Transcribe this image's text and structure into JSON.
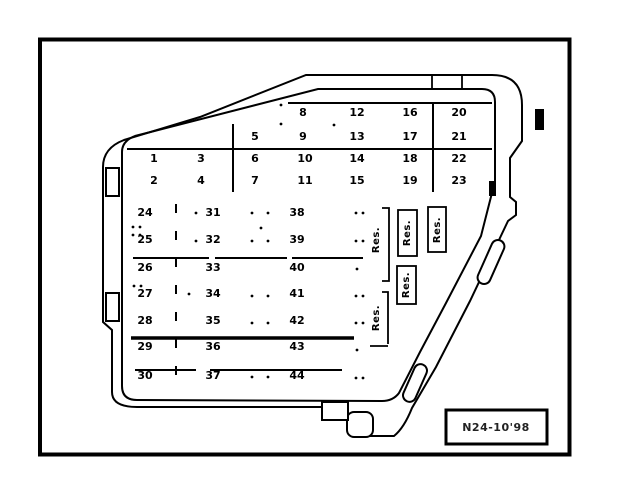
{
  "top_grid": {
    "row1": [
      "8",
      "12",
      "16",
      "20"
    ],
    "row2": [
      "5",
      "9",
      "13",
      "17",
      "21"
    ],
    "row3": [
      "1",
      "3",
      "6",
      "10",
      "14",
      "18",
      "22"
    ],
    "row4": [
      "2",
      "4",
      "7",
      "11",
      "15",
      "19",
      "23"
    ]
  },
  "bottom_grid": {
    "col1": [
      "24",
      "25",
      "26",
      "27",
      "28",
      "29",
      "30"
    ],
    "col2": [
      "31",
      "32",
      "33",
      "34",
      "35",
      "36",
      "37"
    ],
    "col3": [
      "38",
      "39",
      "40",
      "41",
      "42",
      "43",
      "44"
    ]
  },
  "reserved_labels": {
    "res1": "Res.",
    "res2": "Res.",
    "res3": "Res.",
    "res4": "Res.",
    "res5": "Res."
  },
  "caption": {
    "code": "N24-10'98"
  },
  "colors": {
    "ink": "#000000",
    "paper": "#ffffff"
  }
}
